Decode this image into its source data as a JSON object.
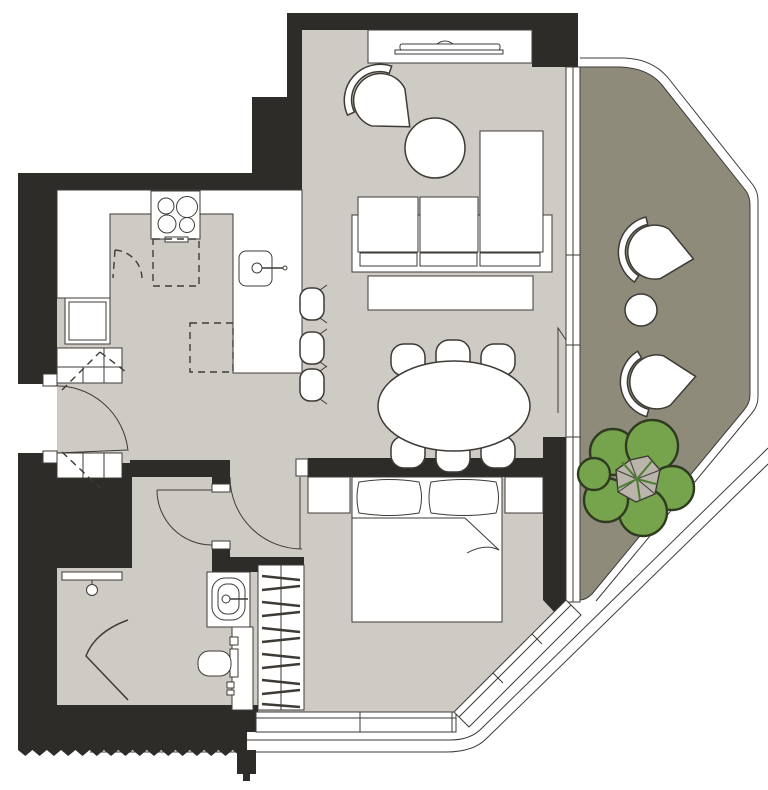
{
  "title": "apartment-floor-plan",
  "colors": {
    "wall": "#2e2c28",
    "floor": "#cecbc4",
    "balcony": "#8e8b7b",
    "white": "#ffffff",
    "line": "#3e3b37",
    "tree": "#76a44c",
    "treeline": "#2f3b21",
    "treecore": "#b9b5aa",
    "treevein": "#4e7d33",
    "bg": "#ffffff"
  },
  "plan": {
    "type": "one-bedroom-apartment-with-balcony",
    "rooms": [
      {
        "name": "kitchen",
        "furniture": [
          "l-shaped-counter",
          "cooktop-4-burners",
          "island-with-sink",
          "bar-stools-x3",
          "appliance-oven",
          "dashed-upper-cabinets"
        ]
      },
      {
        "name": "living-dining-room",
        "furniture": [
          "tv-console",
          "tv",
          "fan-armchair",
          "round-coffee-table",
          "sofa-with-chaise",
          "rug",
          "oval-dining-table",
          "dining-chairs-x6"
        ]
      },
      {
        "name": "entry-hall",
        "furniture": [
          "entry-door",
          "shoe-cabinets-upper",
          "shoe-cabinets-lower"
        ]
      },
      {
        "name": "bathroom",
        "furniture": [
          "shaft-block",
          "shower-bar",
          "shower-screen",
          "vanity-sink",
          "toilet"
        ]
      },
      {
        "name": "bedroom",
        "furniture": [
          "double-bed",
          "pillows-x2",
          "nightstand-left",
          "nightstand-right",
          "wardrobe-hanging-clothes",
          "window-band",
          "diagonal-window"
        ]
      },
      {
        "name": "balcony",
        "furniture": [
          "fan-chair-upper",
          "round-side-table",
          "fan-chair-lower",
          "tree"
        ]
      }
    ],
    "doors": [
      "entry-door-swing",
      "bedroom-door-swing",
      "bathroom-door-swing",
      "balcony-sliding-door"
    ],
    "annotations": [
      "break-line-sawtooth-bottom-wall",
      "facade-outline-curves",
      "balcony-railing"
    ]
  }
}
